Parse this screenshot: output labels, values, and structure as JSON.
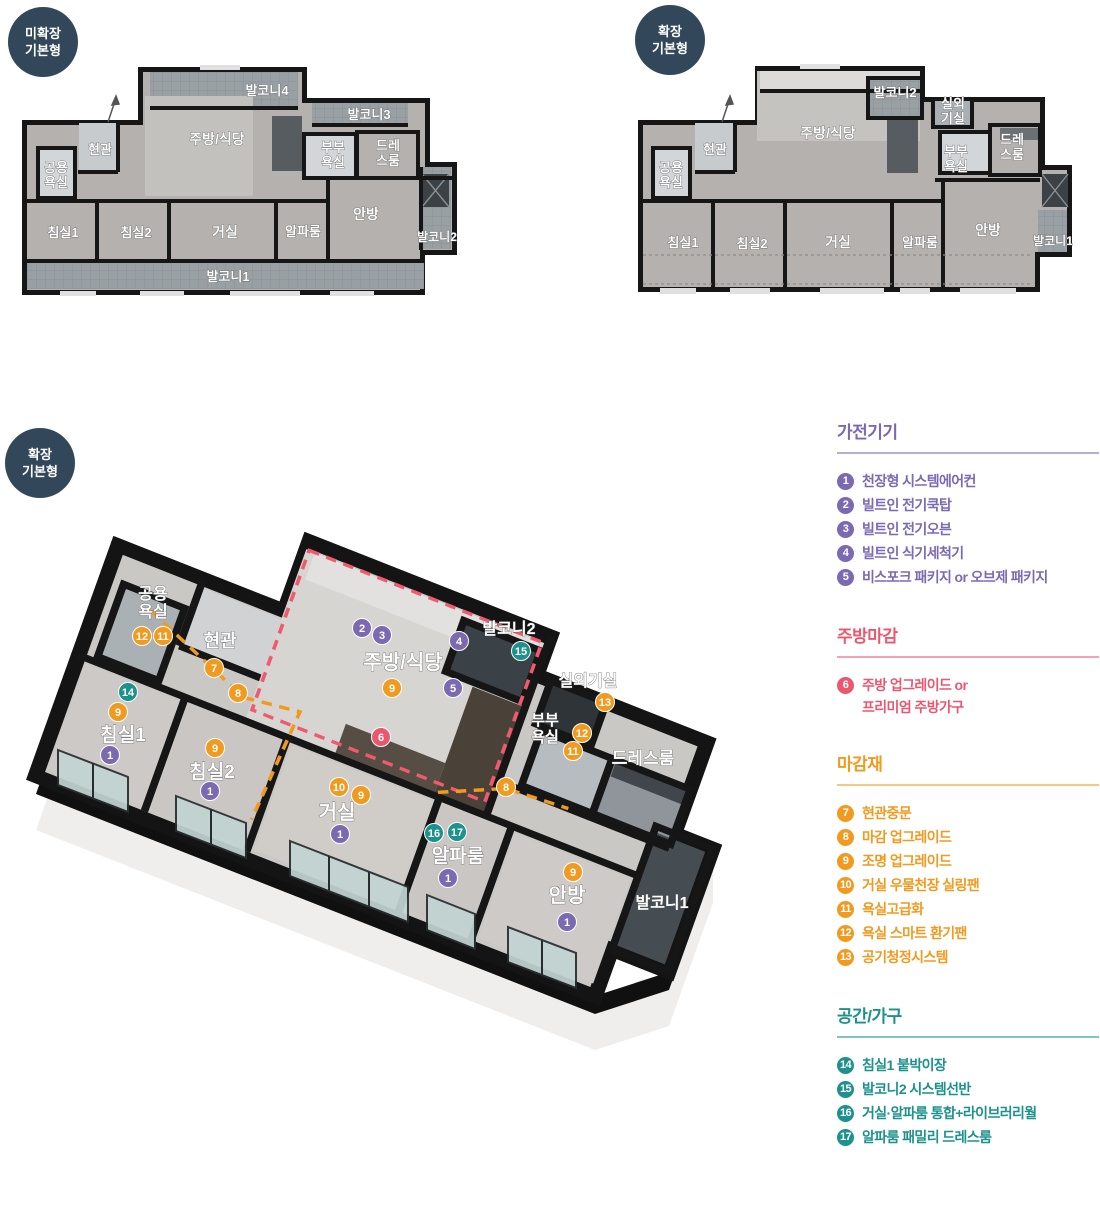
{
  "accent_colors": {
    "purple": "#7b6ab2",
    "pink": "#ea5870",
    "orange": "#f09a1f",
    "teal": "#1d918b",
    "badge_bg": "#32485a"
  },
  "badges": [
    {
      "id": "plan-a",
      "line1": "미확장",
      "line2": "기본형"
    },
    {
      "id": "plan-b",
      "line1": "확장",
      "line2": "기본형"
    },
    {
      "id": "iso",
      "line1": "확장",
      "line2": "기본형"
    }
  ],
  "plan_a": {
    "rooms": [
      {
        "label": "발코니4",
        "x": 267,
        "y": 95,
        "fs": 13
      },
      {
        "label": "발코니3",
        "x": 369,
        "y": 119,
        "fs": 13
      },
      {
        "label": "주방/식당",
        "x": 217,
        "y": 144,
        "fs": 14
      },
      {
        "label": "현관",
        "x": 100,
        "y": 154,
        "fs": 13
      },
      {
        "lines": [
          "공용",
          "욕실"
        ],
        "x": 56,
        "y": 172,
        "fs": 13
      },
      {
        "lines": [
          "부부",
          "욕실"
        ],
        "x": 333,
        "y": 152,
        "fs": 13
      },
      {
        "lines": [
          "드레",
          "스룸"
        ],
        "x": 388,
        "y": 150,
        "fs": 13
      },
      {
        "label": "침실1",
        "x": 63,
        "y": 237,
        "fs": 13
      },
      {
        "label": "침실2",
        "x": 136,
        "y": 237,
        "fs": 13
      },
      {
        "label": "거실",
        "x": 225,
        "y": 237,
        "fs": 14
      },
      {
        "label": "알파룸",
        "x": 303,
        "y": 236,
        "fs": 13
      },
      {
        "label": "안방",
        "x": 366,
        "y": 219,
        "fs": 14
      },
      {
        "label": "발코니2",
        "x": 437,
        "y": 241,
        "fs": 12
      },
      {
        "label": "발코니1",
        "x": 228,
        "y": 281,
        "fs": 13
      }
    ]
  },
  "plan_b": {
    "rooms": [
      {
        "label": "발코니2",
        "x": 895,
        "y": 97,
        "fs": 13
      },
      {
        "lines": [
          "실외",
          "기실"
        ],
        "x": 953,
        "y": 108,
        "fs": 13
      },
      {
        "label": "주방/식당",
        "x": 828,
        "y": 138,
        "fs": 14
      },
      {
        "label": "현관",
        "x": 715,
        "y": 154,
        "fs": 13
      },
      {
        "lines": [
          "공용",
          "욕실"
        ],
        "x": 671,
        "y": 172,
        "fs": 13
      },
      {
        "lines": [
          "부부",
          "욕실"
        ],
        "x": 956,
        "y": 156,
        "fs": 13
      },
      {
        "lines": [
          "드레",
          "스룸"
        ],
        "x": 1012,
        "y": 144,
        "fs": 13
      },
      {
        "label": "침실1",
        "x": 683,
        "y": 247,
        "fs": 13
      },
      {
        "label": "침실2",
        "x": 752,
        "y": 248,
        "fs": 13
      },
      {
        "label": "거실",
        "x": 838,
        "y": 247,
        "fs": 14
      },
      {
        "label": "알파룸",
        "x": 920,
        "y": 247,
        "fs": 13
      },
      {
        "label": "안방",
        "x": 988,
        "y": 235,
        "fs": 14
      },
      {
        "label": "발코니1",
        "x": 1053,
        "y": 245,
        "fs": 12
      }
    ]
  },
  "iso": {
    "rooms": [
      {
        "lines": [
          "공용",
          "욕실"
        ],
        "x": 153,
        "y": 599,
        "fs": 16
      },
      {
        "label": "현관",
        "x": 220,
        "y": 647,
        "fs": 18
      },
      {
        "label": "주방/식당",
        "x": 403,
        "y": 669,
        "fs": 20
      },
      {
        "label": "발코니2",
        "x": 509,
        "y": 634,
        "fs": 16
      },
      {
        "label": "실외기실",
        "x": 588,
        "y": 686,
        "fs": 16
      },
      {
        "lines": [
          "부부",
          "욕실"
        ],
        "x": 545,
        "y": 725,
        "fs": 15
      },
      {
        "label": "드레스룸",
        "x": 643,
        "y": 764,
        "fs": 17
      },
      {
        "label": "침실1",
        "x": 123,
        "y": 741,
        "fs": 19
      },
      {
        "label": "침실2",
        "x": 212,
        "y": 778,
        "fs": 19
      },
      {
        "label": "거실",
        "x": 337,
        "y": 819,
        "fs": 20
      },
      {
        "label": "알파룸",
        "x": 458,
        "y": 862,
        "fs": 19
      },
      {
        "label": "안방",
        "x": 567,
        "y": 902,
        "fs": 20
      },
      {
        "label": "발코니1",
        "x": 662,
        "y": 908,
        "fs": 16
      }
    ],
    "markers": [
      {
        "n": "12",
        "x": 142,
        "y": 636,
        "c": "orange"
      },
      {
        "n": "11",
        "x": 163,
        "y": 636,
        "c": "orange"
      },
      {
        "n": "7",
        "x": 214,
        "y": 668,
        "c": "orange"
      },
      {
        "n": "8",
        "x": 238,
        "y": 693,
        "c": "orange"
      },
      {
        "n": "14",
        "x": 128,
        "y": 692,
        "c": "teal"
      },
      {
        "n": "9",
        "x": 118,
        "y": 712,
        "c": "orange"
      },
      {
        "n": "1",
        "x": 110,
        "y": 755,
        "c": "purple"
      },
      {
        "n": "9",
        "x": 215,
        "y": 748,
        "c": "orange"
      },
      {
        "n": "1",
        "x": 210,
        "y": 791,
        "c": "purple"
      },
      {
        "n": "2",
        "x": 362,
        "y": 628,
        "c": "purple"
      },
      {
        "n": "3",
        "x": 382,
        "y": 635,
        "c": "purple"
      },
      {
        "n": "9",
        "x": 392,
        "y": 688,
        "c": "orange"
      },
      {
        "n": "4",
        "x": 459,
        "y": 641,
        "c": "purple"
      },
      {
        "n": "5",
        "x": 453,
        "y": 688,
        "c": "purple"
      },
      {
        "n": "6",
        "x": 381,
        "y": 737,
        "c": "pink"
      },
      {
        "n": "15",
        "x": 521,
        "y": 651,
        "c": "teal"
      },
      {
        "n": "13",
        "x": 605,
        "y": 702,
        "c": "orange"
      },
      {
        "n": "12",
        "x": 582,
        "y": 733,
        "c": "orange"
      },
      {
        "n": "11",
        "x": 573,
        "y": 751,
        "c": "orange"
      },
      {
        "n": "8",
        "x": 506,
        "y": 787,
        "c": "orange"
      },
      {
        "n": "10",
        "x": 339,
        "y": 787,
        "c": "orange"
      },
      {
        "n": "9",
        "x": 361,
        "y": 795,
        "c": "orange"
      },
      {
        "n": "1",
        "x": 340,
        "y": 834,
        "c": "purple"
      },
      {
        "n": "16",
        "x": 434,
        "y": 833,
        "c": "teal"
      },
      {
        "n": "17",
        "x": 457,
        "y": 832,
        "c": "teal"
      },
      {
        "n": "1",
        "x": 448,
        "y": 878,
        "c": "purple"
      },
      {
        "n": "9",
        "x": 573,
        "y": 872,
        "c": "orange"
      },
      {
        "n": "1",
        "x": 567,
        "y": 922,
        "c": "purple"
      }
    ]
  },
  "legend": {
    "sections": [
      {
        "title": "가전기기",
        "color": "purple",
        "items": [
          {
            "n": "1",
            "text": "천장형 시스템에어컨"
          },
          {
            "n": "2",
            "text": "빌트인 전기쿡탑"
          },
          {
            "n": "3",
            "text": "빌트인 전기오븐"
          },
          {
            "n": "4",
            "text": "빌트인 식기세척기"
          },
          {
            "n": "5",
            "text": "비스포크 패키지 or 오브제 패키지"
          }
        ]
      },
      {
        "title": "주방마감",
        "color": "pink",
        "items": [
          {
            "n": "6",
            "text": "주방 업그레이드 or",
            "text2": "프리미엄 주방가구"
          }
        ]
      },
      {
        "title": "마감재",
        "color": "orange",
        "items": [
          {
            "n": "7",
            "text": "현관중문"
          },
          {
            "n": "8",
            "text": "마감 업그레이드"
          },
          {
            "n": "9",
            "text": "조명 업그레이드"
          },
          {
            "n": "10",
            "text": "거실 우물천장 실링팬"
          },
          {
            "n": "11",
            "text": "욕실고급화"
          },
          {
            "n": "12",
            "text": "욕실 스마트 환기팬"
          },
          {
            "n": "13",
            "text": "공기청정시스템"
          }
        ]
      },
      {
        "title": "공간/가구",
        "color": "teal",
        "items": [
          {
            "n": "14",
            "text": "침실1 붙박이장"
          },
          {
            "n": "15",
            "text": "발코니2 시스템선반"
          },
          {
            "n": "16",
            "text": "거실·알파룸 통합+라이브러리월"
          },
          {
            "n": "17",
            "text": "알파룸 패밀리 드레스룸"
          }
        ]
      }
    ]
  }
}
